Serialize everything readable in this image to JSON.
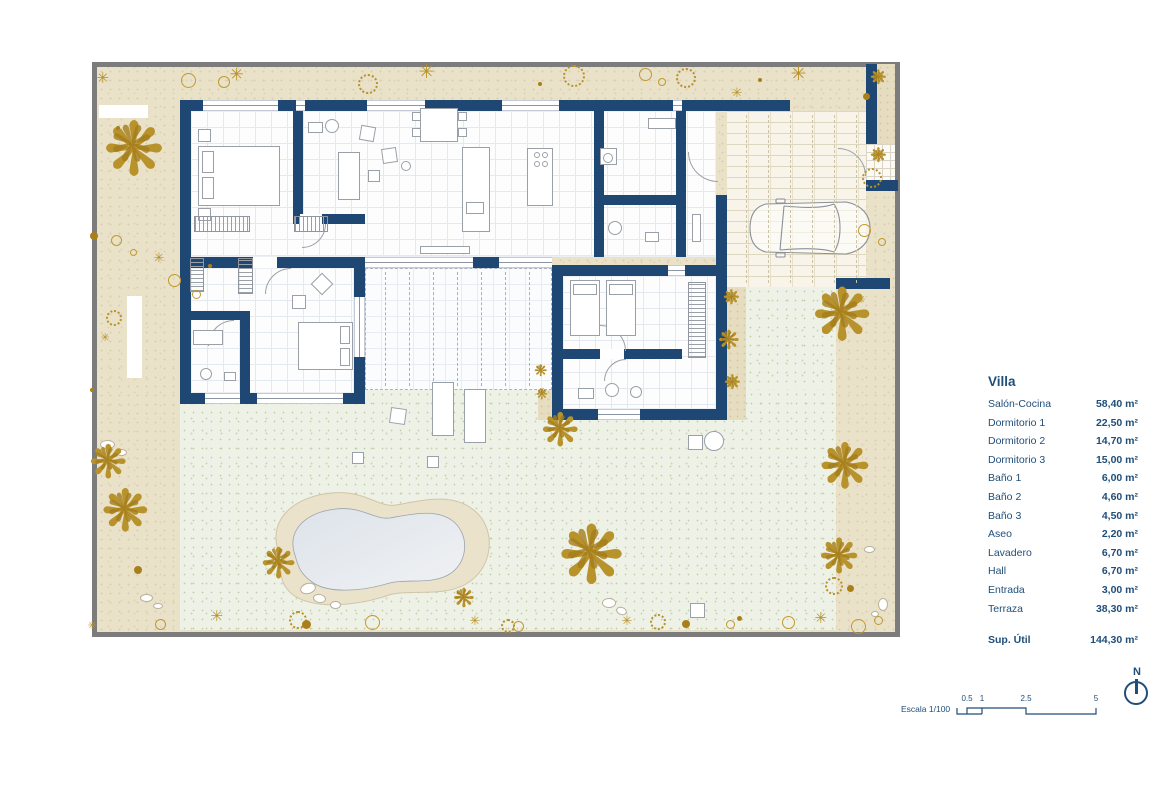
{
  "palette": {
    "wall_navy": "#1f4773",
    "text_navy": "#1f4e79",
    "garden_beige": "#e9e1c8",
    "lawn_green": "#eef1e5",
    "plant_gold": "#b8922a",
    "pool_water": "#e3e9ee",
    "site_border_gray": "#7c7c7c"
  },
  "legend": {
    "title": "Villa",
    "rows": [
      {
        "label": "Salón-Cocina",
        "value": "58,40 m²"
      },
      {
        "label": "Dormitorio 1",
        "value": "22,50 m²"
      },
      {
        "label": "Dormitorio 2",
        "value": "14,70 m²"
      },
      {
        "label": "Dormitorio 3",
        "value": "15,00 m²"
      },
      {
        "label": "Baño 1",
        "value": "6,00 m²"
      },
      {
        "label": "Baño 2",
        "value": "4,60 m²"
      },
      {
        "label": "Baño 3",
        "value": "4,50 m²"
      },
      {
        "label": "Aseo",
        "value": "2,20 m²"
      },
      {
        "label": "Lavadero",
        "value": "6,70 m²"
      },
      {
        "label": "Hall",
        "value": "6,70 m²"
      },
      {
        "label": "Entrada",
        "value": "3,00 m²"
      },
      {
        "label": "Terraza",
        "value": "38,30 m²"
      }
    ],
    "total": {
      "label": "Sup. Útil",
      "value": "144,30 m²"
    }
  },
  "scalebar": {
    "label": "Escala 1/100",
    "ticks": [
      "0.5",
      "1",
      "2.5",
      "5"
    ]
  },
  "north_label": "N"
}
